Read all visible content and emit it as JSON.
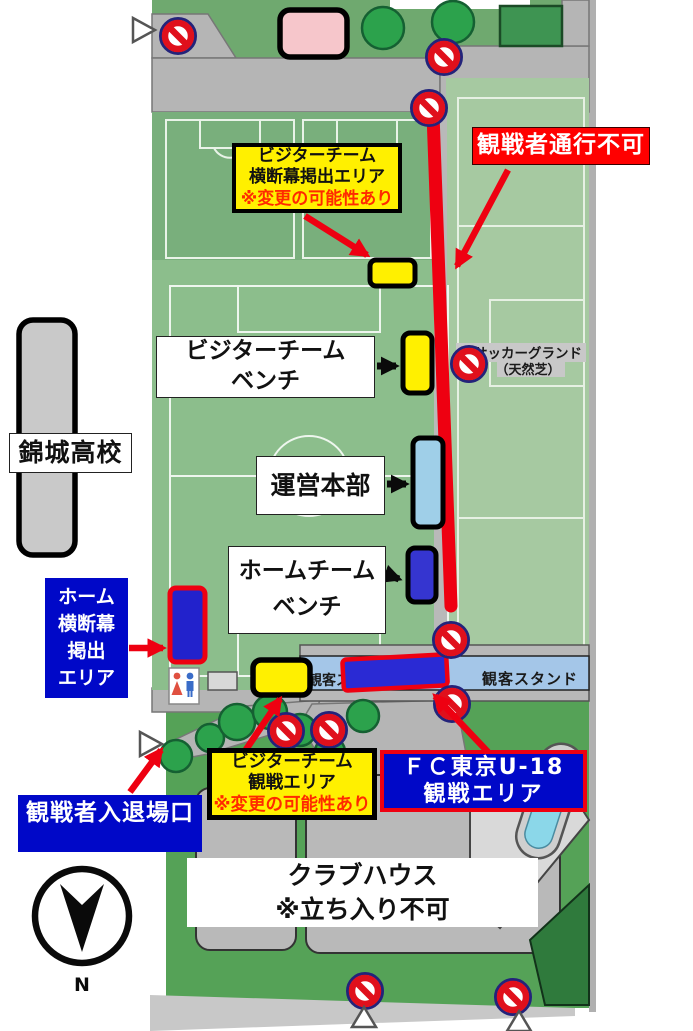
{
  "labels": {
    "no_passage": "観戦者通行不可",
    "visitor_banner": {
      "l1": "ビジターチーム",
      "l2": "横断幕掲出エリア",
      "note": "※変更の可能性あり"
    },
    "visitor_bench": {
      "l1": "ビジターチーム",
      "l2": "ベンチ"
    },
    "school": "錦城高校",
    "hq": "運営本部",
    "home_bench": {
      "l1": "ホームチーム",
      "l2": "ベンチ"
    },
    "home_banner": {
      "l1": "ホーム",
      "l2": "横断幕",
      "l3": "掲出",
      "l4": "エリア"
    },
    "gate": "観戦者入退場口",
    "visitor_area": {
      "l1": "ビジターチーム",
      "l2": "観戦エリア",
      "note": "※変更の可能性あり"
    },
    "fc_tokyo": {
      "l1": "ＦＣ東京U-18",
      "l2": "観戦エリア"
    },
    "clubhouse": {
      "l1": "クラブハウス",
      "l2": "※立ち入り不可"
    },
    "ground": {
      "l1": "サッカーグランド",
      "l2": "（天然芝）"
    },
    "stand": "観客スタンド",
    "stand_partial": "観客ス",
    "compass": "N"
  },
  "colors": {
    "route_red": "#ee0011",
    "label_blue": "#0008c8",
    "label_yellow": "#fff000",
    "label_red": "#ff0000",
    "note_red": "#ff2a00",
    "marker_yellow": "#fff000",
    "marker_blue": "#3535d0",
    "marker_lightblue": "#9fcfe8",
    "stand_blue": "#a4c6e8",
    "field_green": "#8cbe8c",
    "pale_field_green": "#a6c9a1",
    "road_gray": "#b5b5b5",
    "pool_blue": "#8bd7e9"
  }
}
